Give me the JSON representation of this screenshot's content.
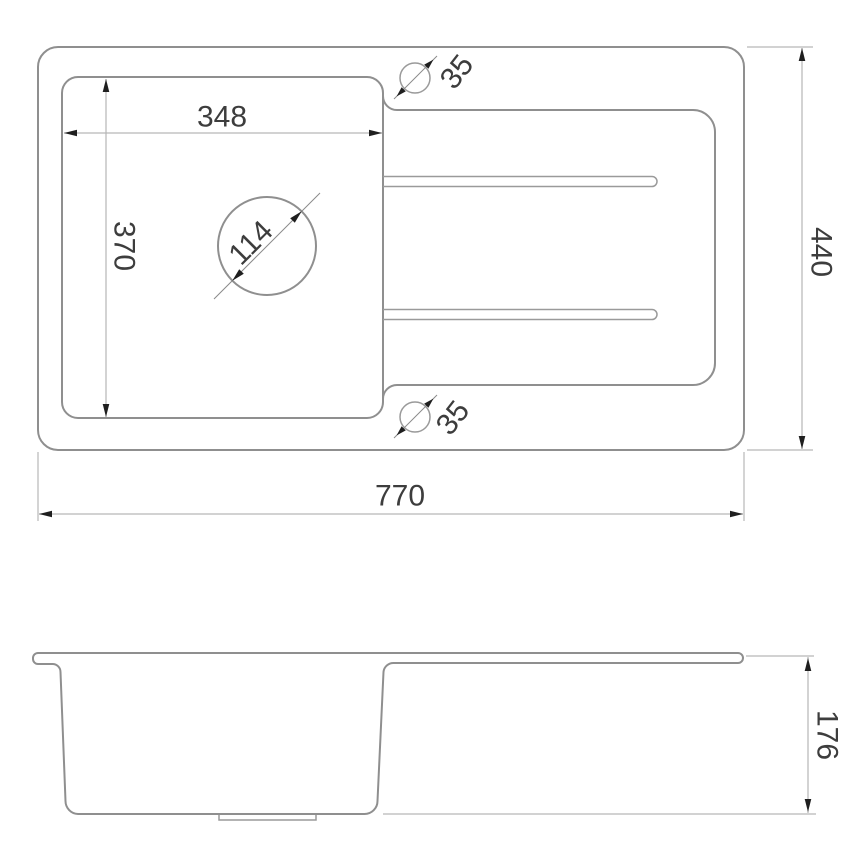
{
  "drawing": {
    "title": "sink-technical-drawing",
    "colors": {
      "outline": "#8f8f8f",
      "dimension_line": "#b6b6b6",
      "arrow": "#1f1f1f",
      "text": "#3d3d3d",
      "background": "#ffffff"
    },
    "top_view": {
      "dimensions": {
        "bowl_width": "348",
        "bowl_depth": "370",
        "drain_diameter": "114",
        "tap_hole_top_diameter": "35",
        "tap_hole_bottom_diameter": "35",
        "overall_width": "770",
        "overall_depth": "440"
      }
    },
    "side_view": {
      "dimensions": {
        "overall_height": "176"
      }
    }
  }
}
